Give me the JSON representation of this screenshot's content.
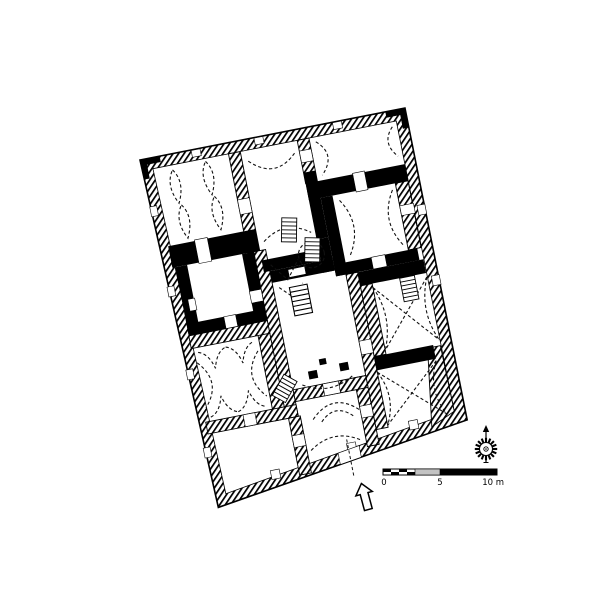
{
  "figure": {
    "kind": "architectural-floor-plan",
    "rotation_deg": -11,
    "features": [
      "hatched masonry outer walls with window niches",
      "solid black interior walls around central halls",
      "rooms with dashed dome, vault and arch projections",
      "stair flights drawn as rung ladders",
      "large white central court room",
      "entrance opening at bottom wall with axis line"
    ]
  },
  "scalebar": {
    "label_0": "0",
    "label_5": "5",
    "label_10": "10 m"
  },
  "icons": {
    "compass": "compass-rose-icon",
    "entrance": "entrance-arrow-icon",
    "stairs": "stairs-icon"
  },
  "colors": {
    "ink": "#000000",
    "paper": "#ffffff",
    "scale_gray": "#c3c3c3"
  }
}
